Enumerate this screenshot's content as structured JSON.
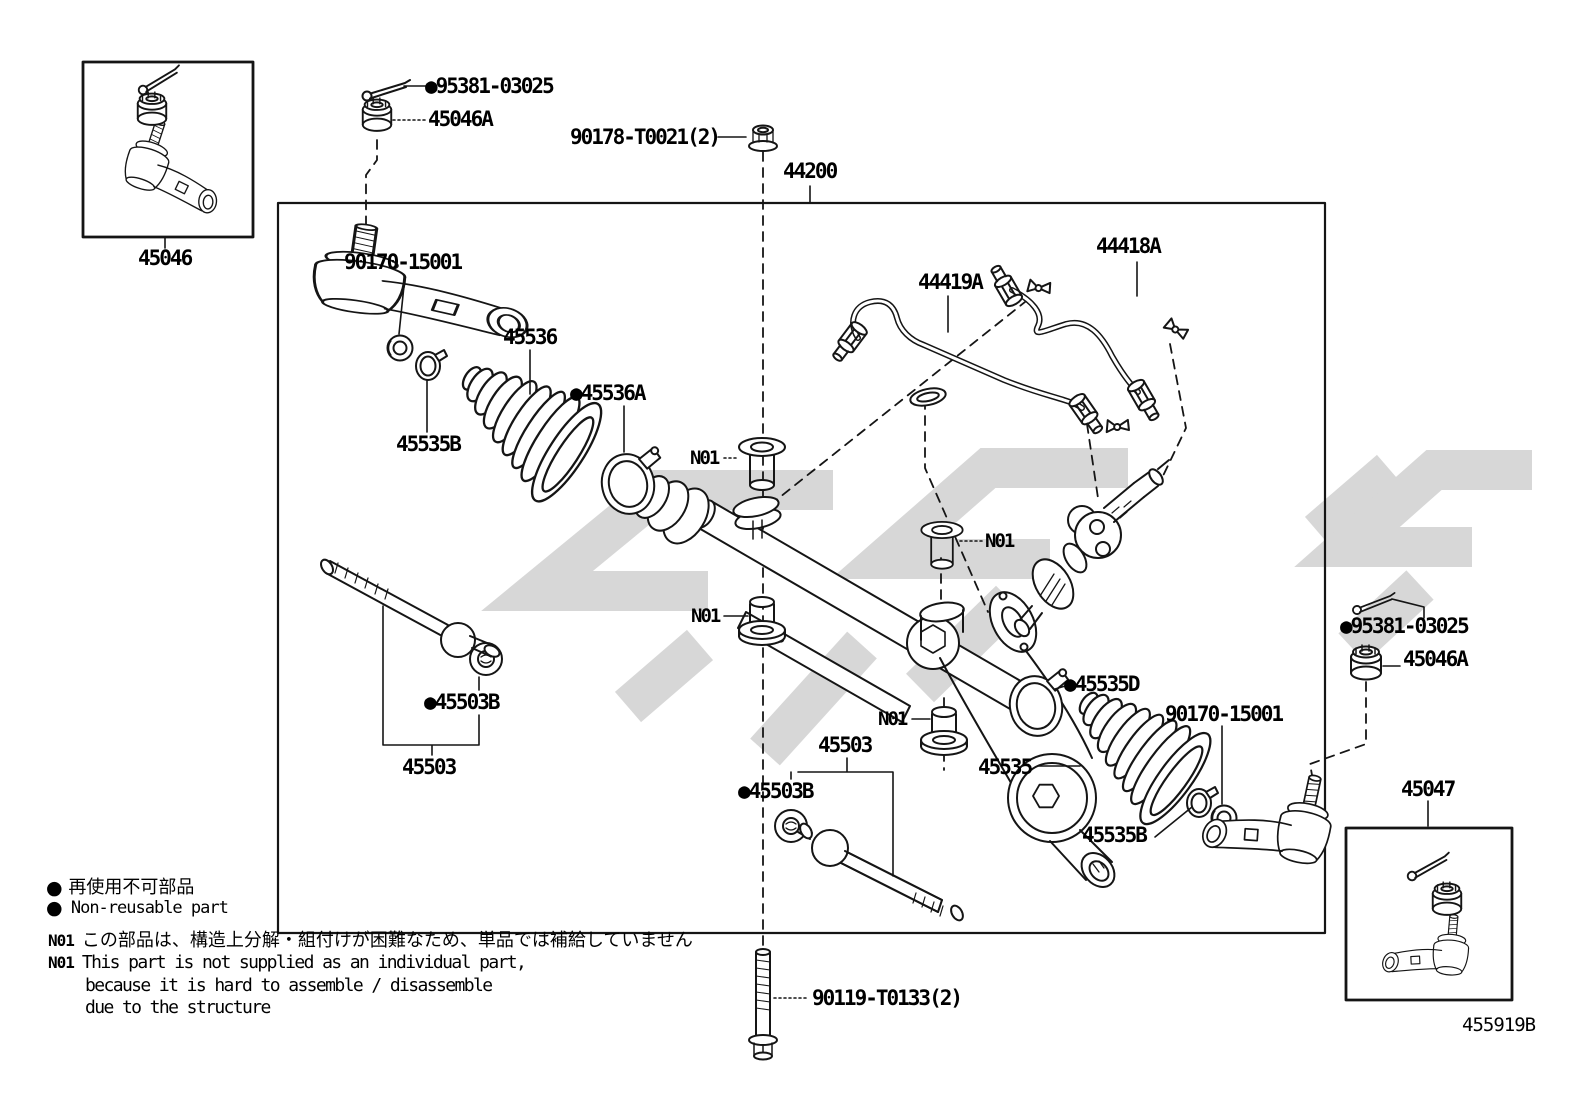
{
  "labels": {
    "cotter_pin_left": "●95381-03025",
    "castle_nut_left": "45046A",
    "rack_mount_nut": "90178-T0021(2)",
    "steering_gear_assembly": "44200",
    "pressure_tube_upper": "44418A",
    "pressure_tube_lower": "44419A",
    "tie_rod_end_lh": "45046",
    "collar_left": "90170-15001",
    "boot_left": "45536",
    "boot_clamp_left": "●45536A",
    "clip_left": "45535B",
    "n01": "N01",
    "boot_clamp_right": "●45535D",
    "rack_end_left": "45503",
    "washer_left": "●45503B",
    "rack_end_bottom": "45503",
    "washer_bottom": "●45503B",
    "boot_right": "45535",
    "collar_right": "90170-15001",
    "clip_right": "45535B",
    "cotter_pin_right": "●95381-03025",
    "castle_nut_right": "45046A",
    "tie_rod_end_rh": "45047",
    "mount_bolt": "90119-T0133(2)",
    "diagram_code": "455919B"
  },
  "legend": {
    "bullet": "●",
    "nonreusable_jp": "再使用不可部品",
    "nonreusable_en": "Non-reusable part",
    "note_id": "N01",
    "note_jp": "この部品は、構造上分解・組付けが困難なため、単品では補給していません",
    "note_en_line1": "This part is not supplied as an individual part,",
    "note_en_line2": "because it is hard to assemble / disassemble",
    "note_en_line3": "due to the structure"
  }
}
